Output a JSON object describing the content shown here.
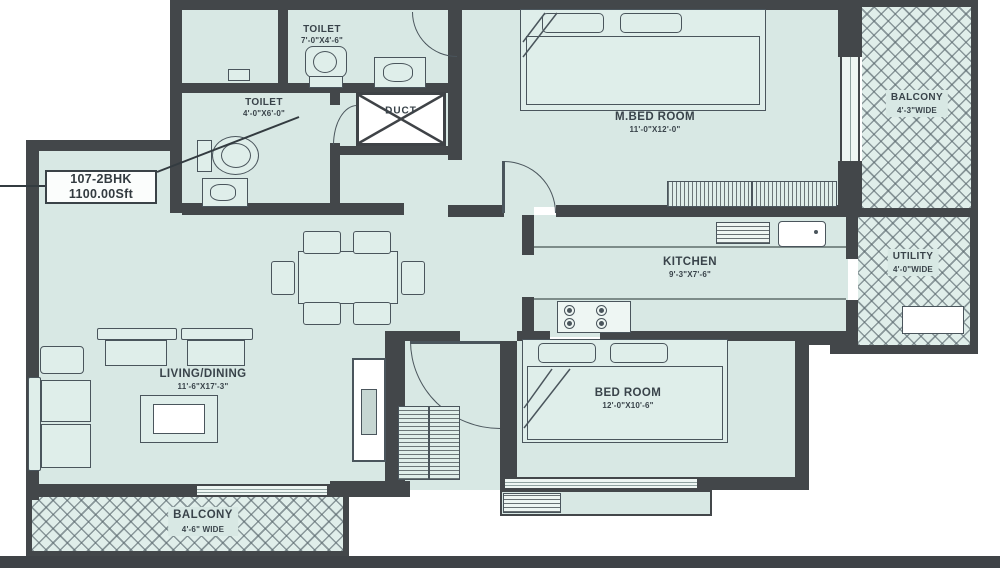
{
  "unit": {
    "line1": "107-2BHK",
    "line2": "1100.00Sft"
  },
  "rooms": {
    "toilet_top": {
      "name": "TOILET",
      "dims": "7'-0\"X4'-6\""
    },
    "toilet_mid": {
      "name": "TOILET",
      "dims": "4'-0\"X6'-0\""
    },
    "duct": {
      "name": "DUCT"
    },
    "master_bedroom": {
      "name": "M.BED ROOM",
      "dims": "11'-0\"X12'-0\""
    },
    "balcony_right": {
      "name": "BALCONY",
      "dims": "4'-3\"WIDE"
    },
    "kitchen": {
      "name": "KITCHEN",
      "dims": "9'-3\"X7'-6\""
    },
    "utility": {
      "name": "UTILITY",
      "dims": "4'-0\"WIDE"
    },
    "living_dining": {
      "name": "LIVING/DINING",
      "dims": "11'-6\"X17'-3\""
    },
    "bedroom": {
      "name": "BED ROOM",
      "dims": "12'-0\"X10'-6\""
    },
    "balcony_bottom": {
      "name": "BALCONY",
      "dims": "4'-6\" WIDE"
    }
  },
  "colors": {
    "floor": "#d8e8e4",
    "wall": "#43474a",
    "furniture_stroke": "#4a555c",
    "text": "#39434a",
    "duct_fill": "#ffffff"
  }
}
